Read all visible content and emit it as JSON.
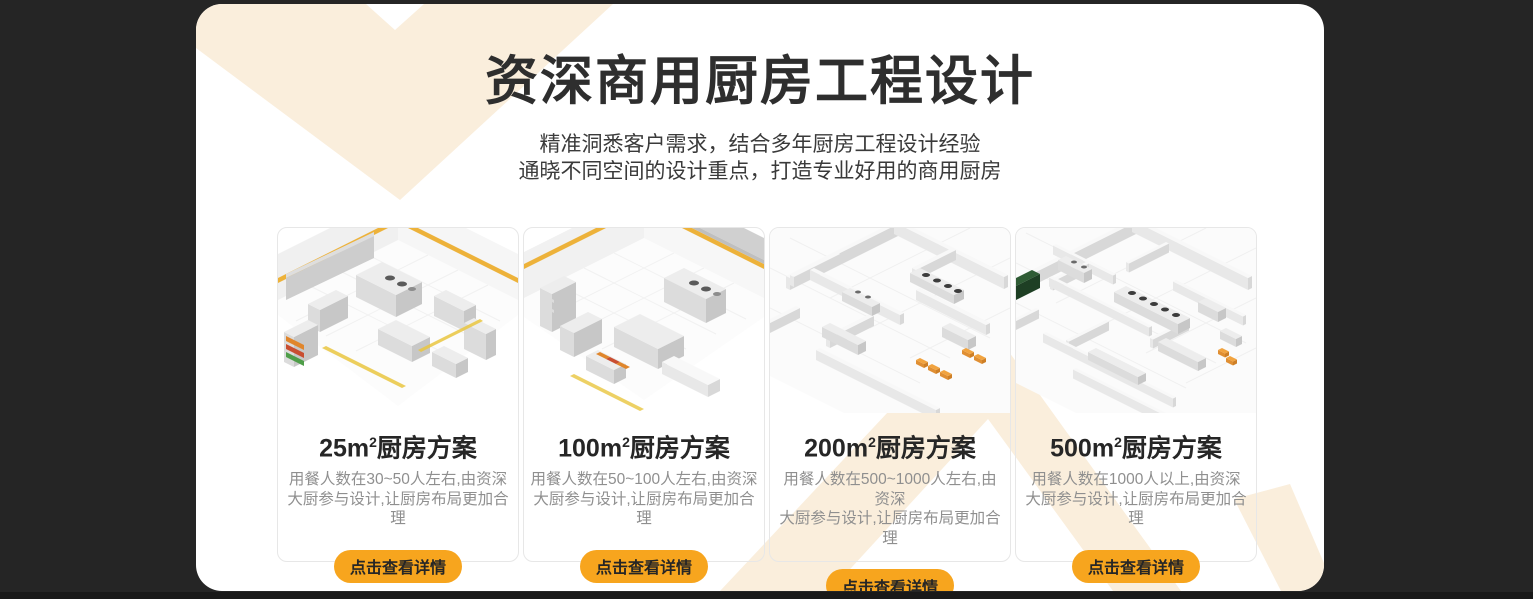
{
  "theme": {
    "page_background": "#252525",
    "bottom_strip": "#191919",
    "panel_background": "#ffffff",
    "chevron_cream": "#faeedc",
    "button_orange": "#f7a51e",
    "button_text": "#262626",
    "title_color": "#2e2e2e",
    "description_color": "#8f8f8f",
    "kitchen_accent_yellow": "#edb23a"
  },
  "header": {
    "title": "资深商用厨房工程设计",
    "subtitle_line1": "精准洞悉客户需求，结合多年厨房工程设计经验",
    "subtitle_line2": "通晓不同空间的设计重点，打造专业好用的商用厨房"
  },
  "cards": [
    {
      "title_area": "25m",
      "title_sup": "2",
      "title_suffix": "厨房方案",
      "desc_line1": "用餐人数在30~50人左右,由资深",
      "desc_line2": "大厨参与设计,让厨房布局更加合理",
      "button_label": "点击查看详情"
    },
    {
      "title_area": "100m",
      "title_sup": "2",
      "title_suffix": "厨房方案",
      "desc_line1": "用餐人数在50~100人左右,由资深",
      "desc_line2": "大厨参与设计,让厨房布局更加合理",
      "button_label": "点击查看详情"
    },
    {
      "title_area": "200m",
      "title_sup": "2",
      "title_suffix": "厨房方案",
      "desc_line1": "用餐人数在500~1000人左右,由资深",
      "desc_line2": "大厨参与设计,让厨房布局更加合理",
      "button_label": "点击查看详情"
    },
    {
      "title_area": "500m",
      "title_sup": "2",
      "title_suffix": "厨房方案",
      "desc_line1": "用餐人数在1000人以上,由资深",
      "desc_line2": "大厨参与设计,让厨房布局更加合理",
      "button_label": "点击查看详情"
    }
  ]
}
